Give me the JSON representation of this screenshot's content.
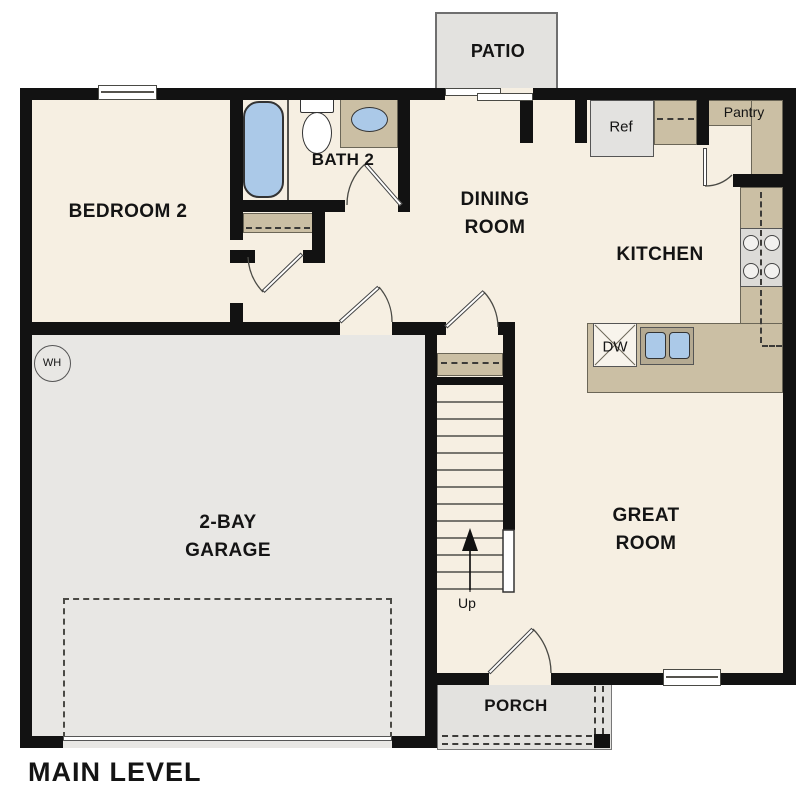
{
  "plan": {
    "title": "MAIN LEVEL",
    "rooms": {
      "patio": "PATIO",
      "bedroom2": "BEDROOM 2",
      "bath2": "BATH 2",
      "dining_line1": "DINING",
      "dining_line2": "ROOM",
      "kitchen": "KITCHEN",
      "pantry": "Pantry",
      "great_line1": "GREAT",
      "great_line2": "ROOM",
      "garage_line1": "2-BAY",
      "garage_line2": "GARAGE",
      "porch": "PORCH"
    },
    "fixtures": {
      "refrigerator": "Ref",
      "dishwasher": "DW",
      "water_heater": "WH",
      "stair_direction": "Up"
    },
    "colors": {
      "wall": "#121212",
      "floor": "#f6efe2",
      "garage": "#e8e7e4",
      "outdoor": "#e3e2df",
      "counter": "#cbbfa4",
      "water": "#abc9e8",
      "text": "#141414"
    }
  }
}
